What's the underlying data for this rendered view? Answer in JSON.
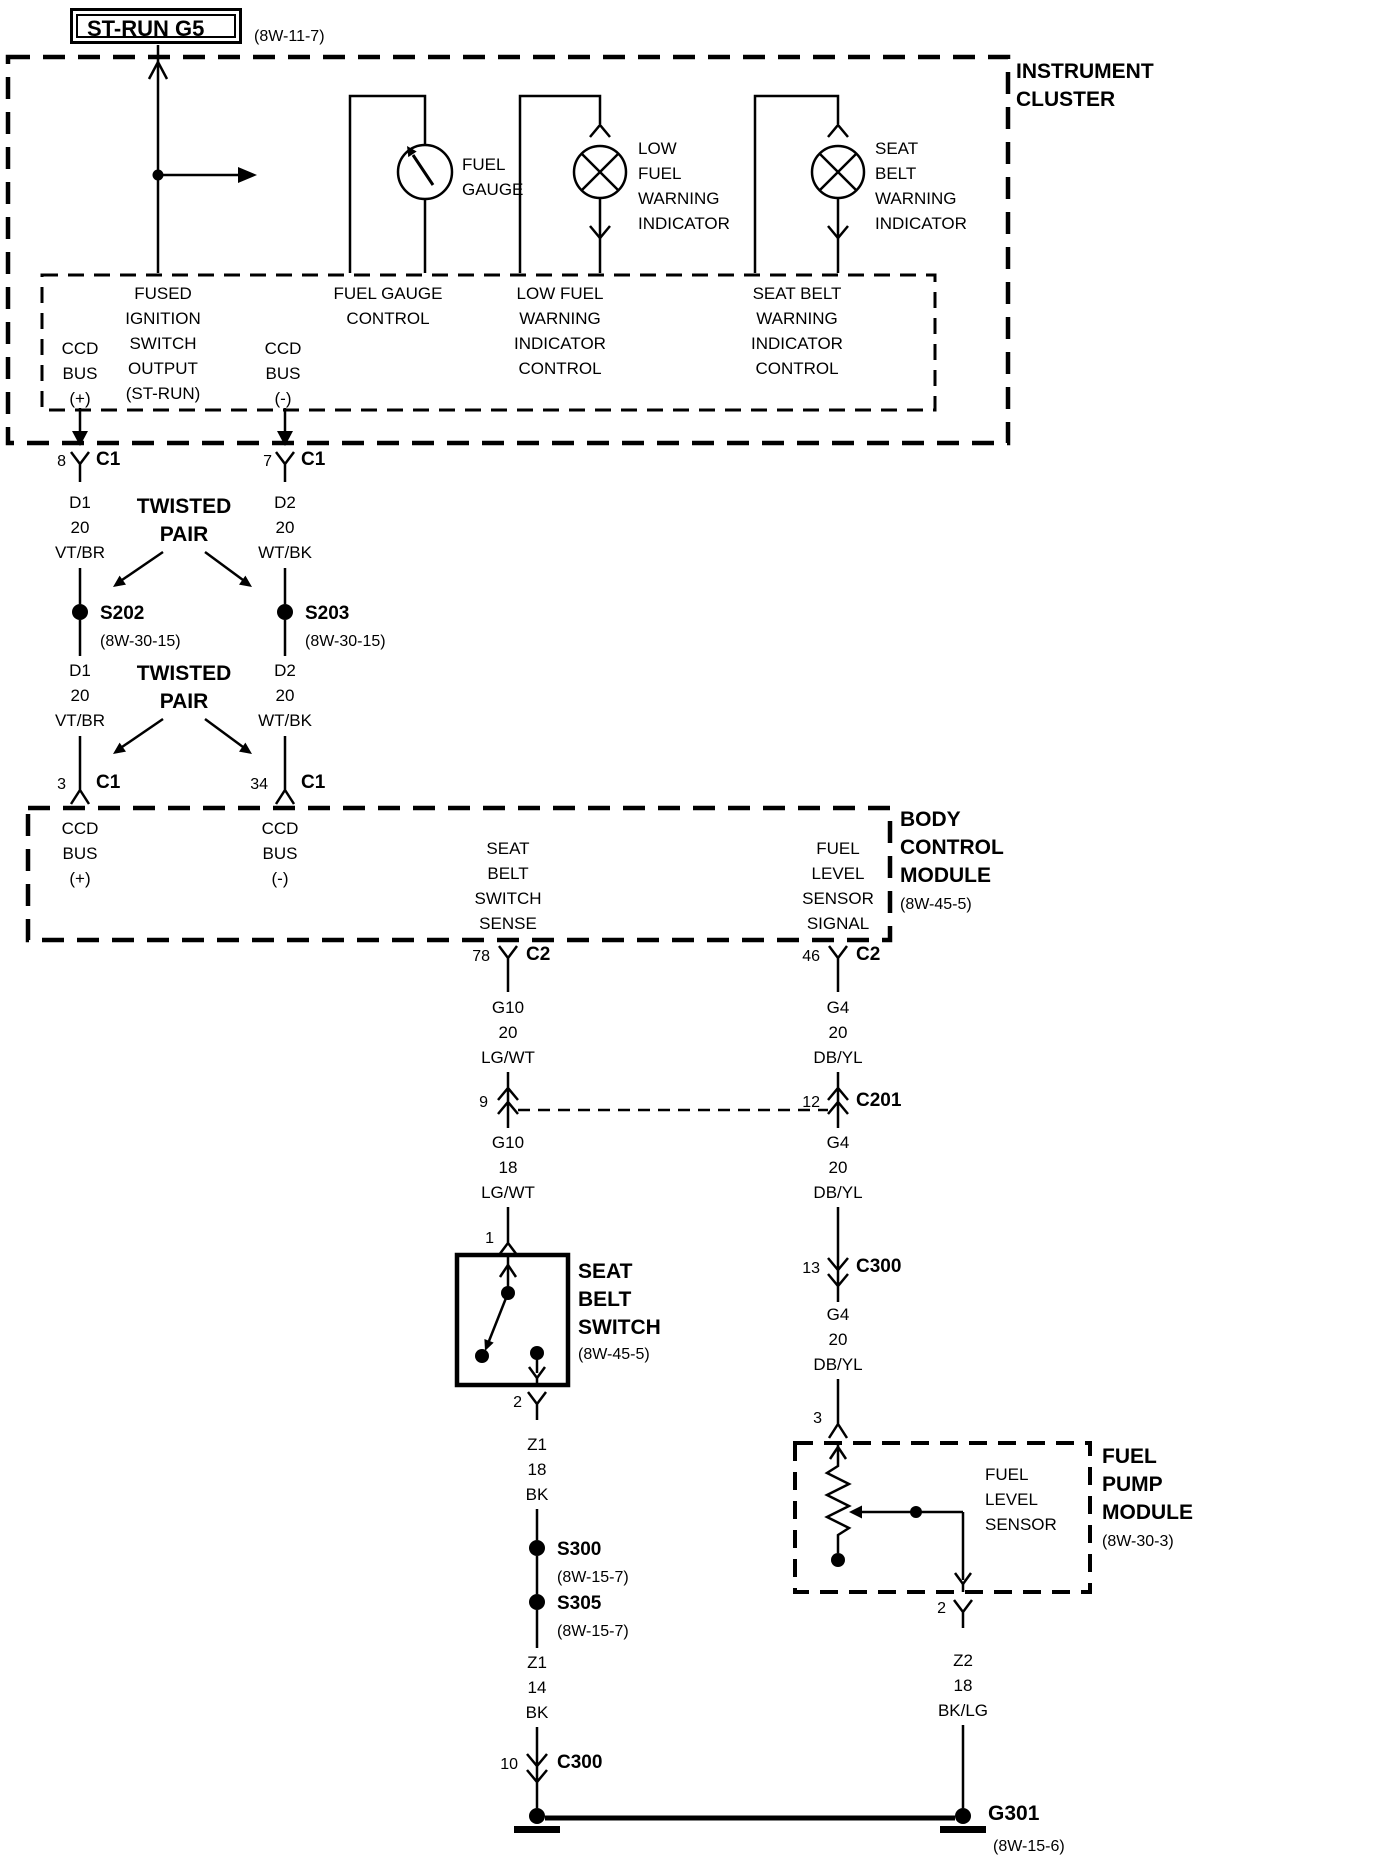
{
  "power_source": {
    "label": "ST-RUN G5",
    "ref": "(8W-11-7)"
  },
  "instrument_cluster": {
    "title": "INSTRUMENT\nCLUSTER",
    "fuel_gauge_label": "FUEL\nGAUGE",
    "low_fuel_label": "LOW\nFUEL\nWARNING\nINDICATOR",
    "seat_belt_label": "SEAT\nBELT\nWARNING\nINDICATOR",
    "pins": {
      "ccd_plus": "CCD\nBUS\n(+)",
      "fused_ign": "FUSED\nIGNITION\nSWITCH\nOUTPUT\n(ST-RUN)",
      "ccd_minus": "CCD\nBUS\n(-)",
      "fuel_gauge_control": "FUEL GAUGE\nCONTROL",
      "low_fuel_control": "LOW FUEL\nWARNING\nINDICATOR\nCONTROL",
      "seat_belt_control": "SEAT BELT\nWARNING\nINDICATOR\nCONTROL"
    },
    "connector_left": {
      "pin": "8",
      "name": "C1"
    },
    "connector_right": {
      "pin": "7",
      "name": "C1"
    }
  },
  "twisted_pair_upper": "TWISTED\nPAIR",
  "twisted_pair_lower": "TWISTED\nPAIR",
  "wires": {
    "d1_upper": "D1\n20\nVT/BR",
    "d2_upper": "D2\n20\nWT/BK",
    "d1_lower": "D1\n20\nVT/BR",
    "d2_lower": "D2\n20\nWT/BK",
    "g10_upper": "G10\n20\nLG/WT",
    "g4_upper": "G4\n20\nDB/YL",
    "g10_lower": "G10\n18\nLG/WT",
    "g4_mid": "G4\n20\nDB/YL",
    "g4_lower": "G4\n20\nDB/YL",
    "z1_upper": "Z1\n18\nBK",
    "z1_lower": "Z1\n14\nBK",
    "z2": "Z2\n18\nBK/LG"
  },
  "splices": {
    "s202": {
      "name": "S202",
      "ref": "(8W-30-15)"
    },
    "s203": {
      "name": "S203",
      "ref": "(8W-30-15)"
    },
    "s300": {
      "name": "S300",
      "ref": "(8W-15-7)"
    },
    "s305": {
      "name": "S305",
      "ref": "(8W-15-7)"
    }
  },
  "body_control_module": {
    "title": "BODY\nCONTROL\nMODULE",
    "ref": "(8W-45-5)",
    "pins": {
      "ccd_plus": "CCD\nBUS\n(+)",
      "ccd_minus": "CCD\nBUS\n(-)",
      "seat_belt_sense": "SEAT\nBELT\nSWITCH\nSENSE",
      "fuel_level_signal": "FUEL\nLEVEL\nSENSOR\nSIGNAL"
    },
    "connector_ccd_plus": {
      "pin": "3",
      "name": "C1"
    },
    "connector_ccd_minus": {
      "pin": "34",
      "name": "C1"
    },
    "connector_seat_belt": {
      "pin": "78",
      "name": "C2"
    },
    "connector_fuel_level": {
      "pin": "46",
      "name": "C2"
    }
  },
  "inline_connectors": {
    "c201_left_pin": "9",
    "c201_right": {
      "pin": "12",
      "name": "C201"
    },
    "c300_fuel": {
      "pin": "13",
      "name": "C300"
    },
    "c300_ground": {
      "pin": "10",
      "name": "C300"
    }
  },
  "seat_belt_switch": {
    "title": "SEAT\nBELT\nSWITCH",
    "ref": "(8W-45-5)",
    "pin_in": "1",
    "pin_out": "2"
  },
  "fuel_pump_module": {
    "title": "FUEL\nPUMP\nMODULE",
    "ref": "(8W-30-3)",
    "sensor_label": "FUEL\nLEVEL\nSENSOR",
    "pin_in": "3",
    "pin_out": "2"
  },
  "grounds": {
    "g301": {
      "name": "G301",
      "ref": "(8W-15-6)"
    }
  }
}
